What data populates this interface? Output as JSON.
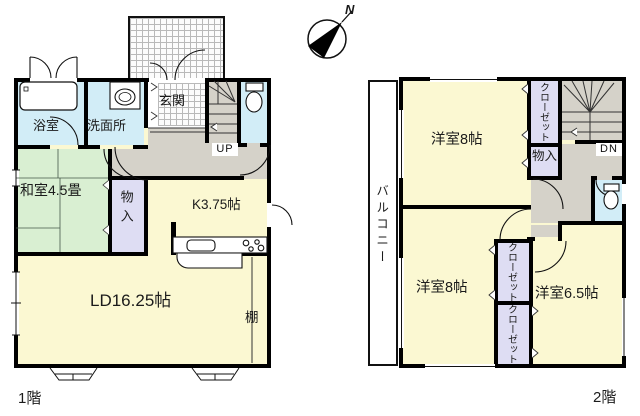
{
  "compass": {
    "north_label": "N"
  },
  "floor1": {
    "label": "1階",
    "rooms": {
      "bath": "浴室",
      "washroom": "洗面所",
      "entrance": "玄関",
      "stairs_direction": "UP",
      "japanese_room": "和室4.5畳",
      "storage": "物入",
      "kitchen": "K3.75帖",
      "living_dining": "LD16.25帖",
      "shelf": "棚"
    }
  },
  "floor2": {
    "label": "2階",
    "rooms": {
      "bedroom_north": "洋室8帖",
      "bedroom_west": "洋室8帖",
      "bedroom_east": "洋室6.5帖",
      "closet_north": "クローゼット",
      "closet_mid": "クローゼット",
      "closet_south": "クローゼット",
      "storage": "物入",
      "stairs_direction": "DN",
      "balcony": "バルコニー"
    }
  },
  "colors": {
    "room_yellow": "#fbf8d2",
    "tatami_green": "#d9efd2",
    "wet_area_blue": "#d2edf7",
    "closet_lavender": "#deddf3",
    "hall_gray": "#d5d2c9",
    "wall_black": "#000000"
  }
}
